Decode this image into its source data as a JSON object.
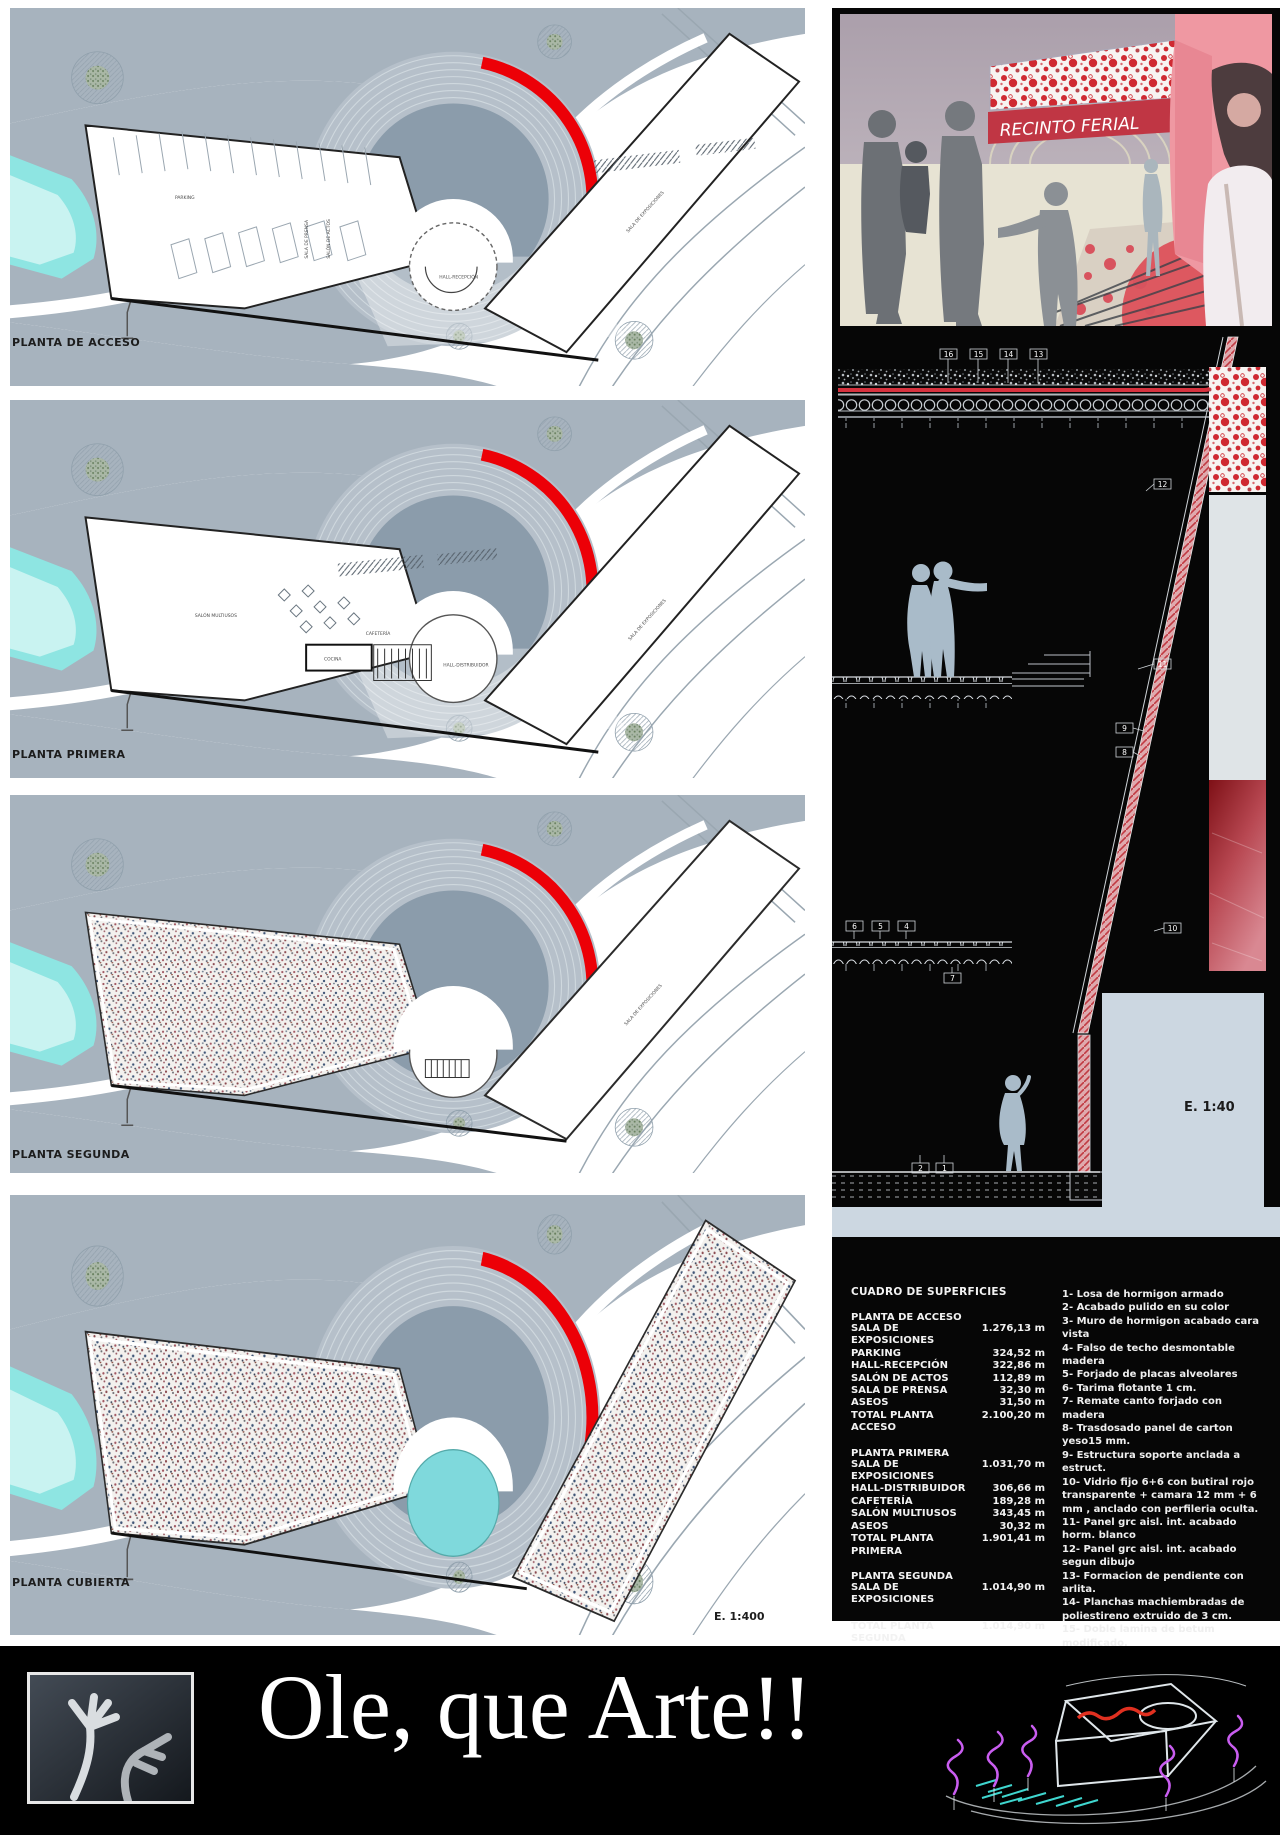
{
  "plans": {
    "scale": "E. 1:400",
    "floor1": {
      "label": "PLANTA DE ACCESO",
      "rooms": {
        "parking": "PARKING",
        "prensa": "SALA DE PRENSA",
        "actos": "SALÓN DE ACTOS",
        "hall": "HALL-RECEPCIÓN",
        "expo": "SALA DE EXPOSICIONES"
      }
    },
    "floor2": {
      "label": "PLANTA PRIMERA",
      "rooms": {
        "multiusos": "SALÓN MULTIUSOS",
        "cocina": "COCINA",
        "cafeteria": "CAFETERÍA",
        "hall": "HALL-DISTRIBUIDOR",
        "expo": "SALA DE EXPOSICIONES"
      }
    },
    "floor3": {
      "label": "PLANTA SEGUNDA",
      "rooms": {
        "expo": "SALA DE EXPOSICIONES"
      }
    },
    "floor4": {
      "label": "PLANTA CUBIERTA"
    }
  },
  "render": {
    "banner_text": "RECINTO FERIAL"
  },
  "section": {
    "scale": "E. 1:40",
    "callouts": [
      "16",
      "15",
      "14",
      "13",
      "12",
      "11",
      "9",
      "8",
      "6",
      "5",
      "4",
      "7",
      "10",
      "2",
      "1"
    ]
  },
  "surfaces": {
    "title": "CUADRO DE SUPERFICIES",
    "g1": {
      "header": "PLANTA DE ACCESO",
      "rows": [
        {
          "label": "SALA DE EXPOSICIONES",
          "value": "1.276,13 m"
        },
        {
          "label": "PARKING",
          "value": "324,52 m"
        },
        {
          "label": "HALL-RECEPCIÓN",
          "value": "322,86 m"
        },
        {
          "label": "SALÓN DE ACTOS",
          "value": "112,89 m"
        },
        {
          "label": "SALA DE PRENSA",
          "value": "32,30 m"
        },
        {
          "label": "ASEOS",
          "value": "31,50 m"
        },
        {
          "label": "TOTAL PLANTA ACCESO",
          "value": "2.100,20 m"
        }
      ]
    },
    "g2": {
      "header": "PLANTA PRIMERA",
      "rows": [
        {
          "label": "SALA DE EXPOSICIONES",
          "value": "1.031,70 m"
        },
        {
          "label": "HALL-DISTRIBUIDOR",
          "value": "306,66 m"
        },
        {
          "label": "CAFETERÍA",
          "value": "189,28 m"
        },
        {
          "label": "SALÓN MULTIUSOS",
          "value": "343,45 m"
        },
        {
          "label": "ASEOS",
          "value": "30,32 m"
        },
        {
          "label": "TOTAL PLANTA PRIMERA",
          "value": "1.901,41 m"
        }
      ]
    },
    "g3": {
      "header": "PLANTA SEGUNDA",
      "rows": [
        {
          "label": "SALA DE EXPOSICIONES",
          "value": "1.014,90 m"
        },
        {
          "label": "TOTAL PLANTA SEGUNDA",
          "value": "1.014,90 m"
        }
      ]
    },
    "total": {
      "label": "TOTAL",
      "value": "5.016,51 m"
    }
  },
  "notes": {
    "items": [
      "1- Losa de hormigon armado",
      "2- Acabado pulido en su color",
      "3- Muro de hormigon acabado cara vista",
      "4- Falso de techo desmontable madera",
      "5- Forjado de placas alveolares",
      "6- Tarima flotante 1 cm.",
      "7- Remate canto forjado con madera",
      "8- Trasdosado panel de carton yeso15 mm.",
      "9- Estructura soporte anclada a estruct.",
      "10- Vidrio fijo 6+6 con butiral rojo transparente + camara 12 mm + 6 mm , anclado con perfileria oculta.",
      "11- Panel grc aisl. int. acabado horm. blanco",
      "12- Panel grc aisl. int. acabado segun dibujo",
      "13- Formacion de pendiente con arlita.",
      "14- Planchas machiembradas de poliestireno extruido de 3 cm.",
      "15- Doble lamina de betum modificado.",
      "16- Grava de proteccion"
    ]
  },
  "banner": {
    "title": "Ole, que Arte!!"
  },
  "colors": {
    "accent_red": "#ec0007",
    "terrain": "#a7b3be",
    "amphitheatre": "#8b9cab",
    "water": "#8ee5e2",
    "panel_black": "#060606",
    "light_band": "#ccd7e1",
    "render_pink": "#ef98a2"
  }
}
